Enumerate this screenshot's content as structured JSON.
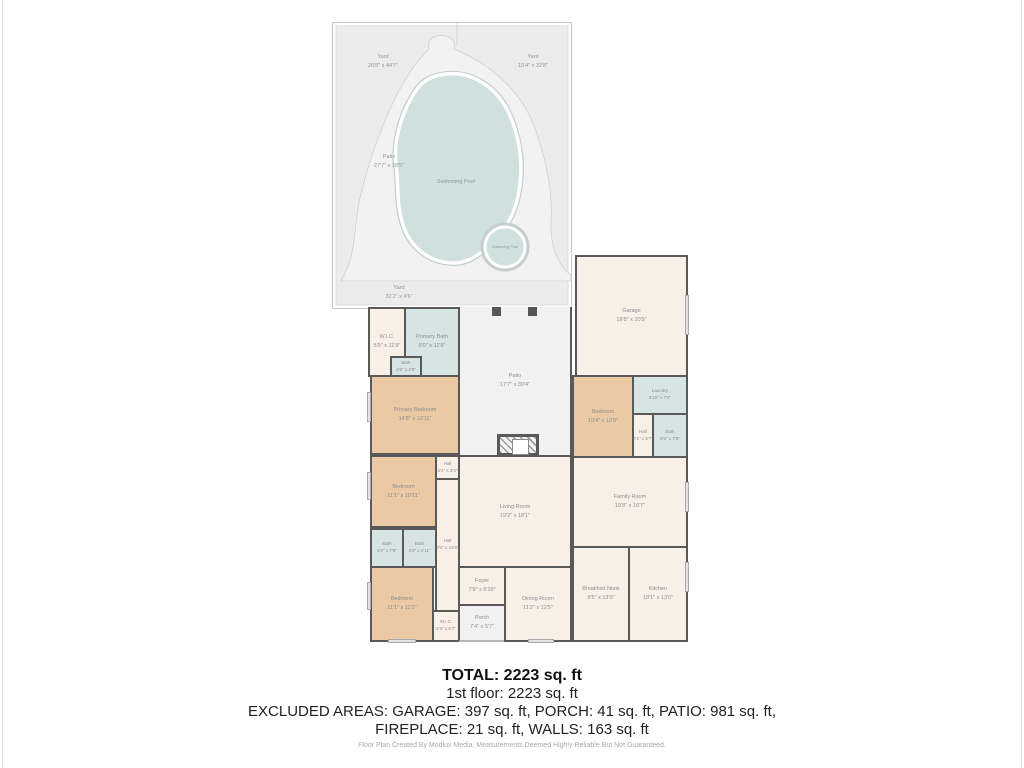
{
  "colors": {
    "wall": "#595959",
    "bedroom_fill": "#eac9a4",
    "bath_fill": "#d6e4e3",
    "room_fill": "#f8efe7",
    "pool_fill": "#cfe0df",
    "yard_fill": "#ececec"
  },
  "outdoor": {
    "yard_left": {
      "name": "Yard",
      "dims": "20'8\" x 44'7\""
    },
    "yard_right": {
      "name": "Yard",
      "dims": "19'4\" x 32'8\""
    },
    "yard_bottom": {
      "name": "Yard",
      "dims": "32'2\" x 4'6\""
    },
    "pool_patio": {
      "name": "Patio",
      "dims": "27'7\" x 38'5\""
    },
    "pool": {
      "name": "Swimming Pool"
    },
    "spa": {
      "name": "Swimming Pool"
    }
  },
  "rooms": [
    {
      "name": "W.I.C.",
      "dims": "5'5\" x 11'9\""
    },
    {
      "name": "Primary Bath",
      "dims": "9'0\" x 11'9\""
    },
    {
      "name": "Bath",
      "dims": "4'6\" x 2'9\""
    },
    {
      "name": "Primary Bedroom",
      "dims": "14'8\" x 13'11\""
    },
    {
      "name": "Hall",
      "dims": "2'4\" x 3'3\""
    },
    {
      "name": "Bedroom",
      "dims": "11'1\" x 10'11\""
    },
    {
      "name": "Bath",
      "dims": "5'9\" x 7'8\""
    },
    {
      "name": "Bath",
      "dims": "5'0\" x 4'11\""
    },
    {
      "name": "Hall",
      "dims": "3'4\" x 16'5\""
    },
    {
      "name": "Bedroom",
      "dims": "11'1\" x 11'2\""
    },
    {
      "name": "W.I.C.",
      "dims": "2'4\" x 5'7\""
    },
    {
      "name": "Foyer",
      "dims": "7'9\" x 6'10\""
    },
    {
      "name": "Porch",
      "dims": "7'4\" x 5'7\""
    },
    {
      "name": "Dining Room",
      "dims": "11'2\" x 12'5\""
    },
    {
      "name": "Living Room",
      "dims": "19'2\" x 18'1\""
    },
    {
      "name": "Patio",
      "dims": "17'7\" x 39'4\""
    },
    {
      "name": "Garage",
      "dims": "19'8\" x 20'5\""
    },
    {
      "name": "Bedroom",
      "dims": "10'4\" x 10'8\""
    },
    {
      "name": "Laundry",
      "dims": "8'10\" x 7'5\""
    },
    {
      "name": "Hall",
      "dims": "3'1\" x 5'7\""
    },
    {
      "name": "Bath",
      "dims": "5'5\" x 7'9\""
    },
    {
      "name": "Family Room",
      "dims": "19'8\" x 16'7\""
    },
    {
      "name": "Breakfast Nook",
      "dims": "9'5\" x 13'0\""
    },
    {
      "name": "Kitchen",
      "dims": "18'1\" x 13'0\""
    }
  ],
  "summary": {
    "total": "TOTAL: 2223 sq. ft",
    "floor1": "1st floor: 2223 sq. ft",
    "excluded1": "EXCLUDED AREAS: GARAGE: 397 sq. ft, PORCH: 41 sq. ft, PATIO: 981 sq. ft,",
    "excluded2": "FIREPLACE: 21 sq. ft, WALLS: 163 sq. ft"
  },
  "footer": {
    "note": "Floor Plan Created By Modlux Media. Measurements Deemed Highly Reliable But Not Guaranteed."
  }
}
